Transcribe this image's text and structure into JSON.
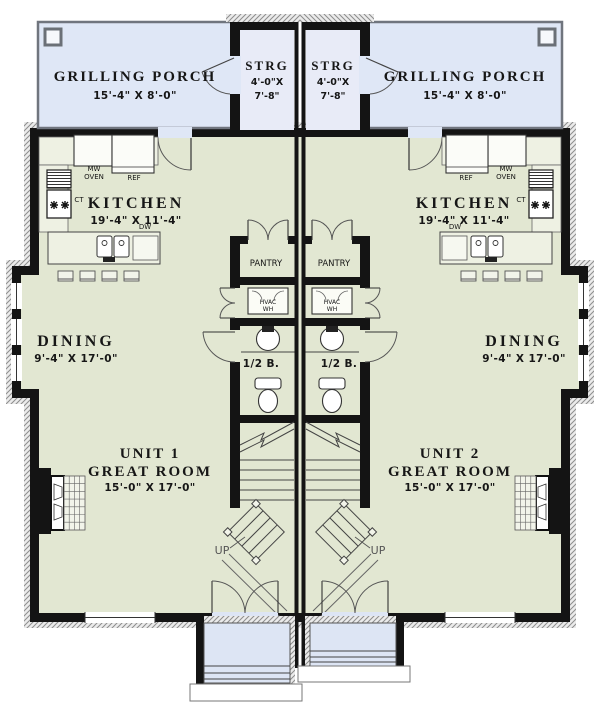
{
  "colors": {
    "floor_green": "#e2e7d2",
    "porch_blue": "#dfe7f6",
    "storage_blue": "#e8ebf7",
    "stoop_blue": "#dde5f4",
    "wall_black": "#141414",
    "counter": "#eef1e3"
  },
  "unit1": {
    "grilling_porch": {
      "label": "GRILLING PORCH",
      "dims": "15'-4\" X 8'-0\""
    },
    "storage": {
      "label": "STRG",
      "dims1": "4'-0\"X",
      "dims2": "7'-8\""
    },
    "kitchen": {
      "label": "KITCHEN",
      "dims": "19'-4\" X 11'-4\"",
      "mw1": "MW",
      "mw2": "OVEN",
      "ref": "REF",
      "ct": "CT",
      "dw": "DW"
    },
    "pantry": {
      "label": "PANTRY"
    },
    "utility": {
      "line1": "HVAC",
      "line2": "WH"
    },
    "half_bath": {
      "label": "1/2 B."
    },
    "dining": {
      "label": "DINING",
      "dims": "9'-4\" X 17'-0\""
    },
    "great_room": {
      "line1": "UNIT 1",
      "line2": "GREAT ROOM",
      "dims": "15'-0\" X 17'-0\""
    },
    "stairs": {
      "label": "UP"
    }
  },
  "unit2": {
    "grilling_porch": {
      "label": "GRILLING PORCH",
      "dims": "15'-4\" X 8'-0\""
    },
    "storage": {
      "label": "STRG",
      "dims1": "4'-0\"X",
      "dims2": "7'-8\""
    },
    "kitchen": {
      "label": "KITCHEN",
      "dims": "19'-4\" X 11'-4\"",
      "mw1": "MW",
      "mw2": "OVEN",
      "ref": "REF",
      "ct": "CT",
      "dw": "DW"
    },
    "pantry": {
      "label": "PANTRY"
    },
    "utility": {
      "line1": "HVAC",
      "line2": "WH"
    },
    "half_bath": {
      "label": "1/2 B."
    },
    "dining": {
      "label": "DINING",
      "dims": "9'-4\" X 17'-0\""
    },
    "great_room": {
      "line1": "UNIT 2",
      "line2": "GREAT ROOM",
      "dims": "15'-0\" X 17'-0\""
    },
    "stairs": {
      "label": "UP"
    }
  }
}
